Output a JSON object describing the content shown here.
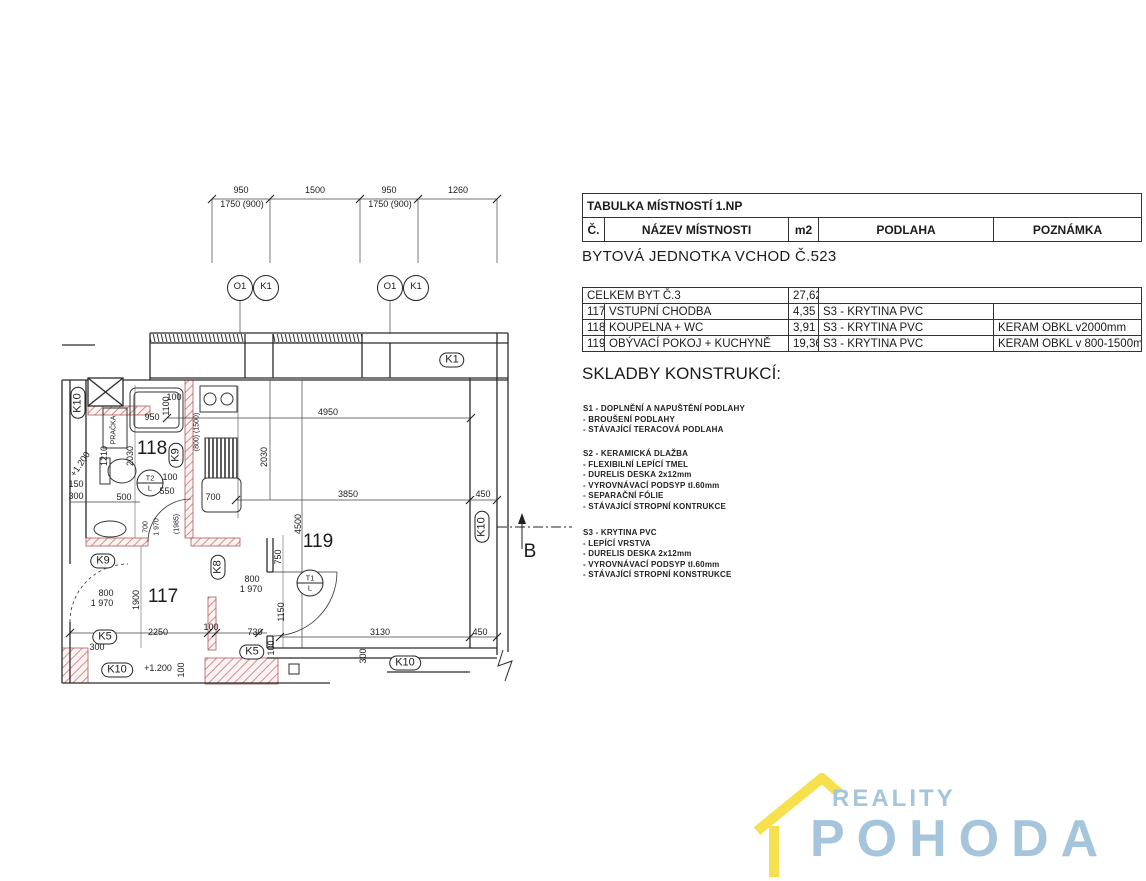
{
  "subtitle": "BYTOVÁ JEDNOTKA VCHOD Č.523",
  "room_table": {
    "title": "TABULKA MÍSTNOSTÍ 1.NP",
    "headers": [
      "Č.",
      "NÁZEV MÍSTNOSTI",
      "m2",
      "PODLAHA",
      "POZNÁMKA"
    ],
    "total_row": {
      "label": "CELKEM BYT Č.3",
      "m2": "27,62"
    },
    "rows": [
      {
        "no": "117",
        "name": "VSTUPNÍ CHODBA",
        "m2": "4,35",
        "floor": "S3 - KRYTINA PVC",
        "note": ""
      },
      {
        "no": "118",
        "name": "KOUPELNA + WC",
        "m2": "3,91",
        "floor": "S3 - KRYTINA PVC",
        "note": "KERAM OBKL v2000mm"
      },
      {
        "no": "119",
        "name": "OBÝVACÍ POKOJ + KUCHYNĚ",
        "m2": "19,36",
        "floor": "S3 - KRYTINA PVC",
        "note": "KERAM OBKL v 800-1500mm"
      }
    ]
  },
  "skladby": {
    "heading": "SKLADBY KONSTRUKCÍ:",
    "sections": [
      {
        "top": 404,
        "lines": [
          "S1 - DOPLNĚNÍ A NAPUŠTĚNÍ PODLAHY",
          " - BROUŠENÍ PODLAHY",
          " - STÁVAJÍCÍ TERACOVÁ PODLAHA"
        ]
      },
      {
        "top": 449,
        "lines": [
          "S2 - KERAMICKÁ DLAŽBA",
          " - FLEXIBILNÍ LEPÍCÍ TMEL",
          " - DURELIS DESKA 2x12mm",
          " - VYROVNÁVACÍ PODSYP tl.60mm",
          " - SEPARAČNÍ FÓLIE",
          " - STÁVAJÍCÍ STROPNÍ KONTRUKCE"
        ]
      },
      {
        "top": 528,
        "lines": [
          "S3 - KRYTINA PVC",
          " - LEPÍCÍ VRSTVA",
          " - DURELIS DESKA 2x12mm",
          " - VYROVNÁVACÍ PODSYP tl.60mm",
          " - STÁVAJÍCÍ STROPNÍ KONSTRUKCE"
        ]
      }
    ]
  },
  "logo": {
    "brand_top": "REALITY",
    "brand_bottom": "POHODA",
    "colors": {
      "roof": "#f6e04e",
      "text": "#a4c5db"
    }
  },
  "plan": {
    "colors": {
      "wall_hatch": "#d08f8f",
      "lines": "#2b2b2b"
    },
    "labels": [
      {
        "t": "950",
        "x": 241,
        "y": 190,
        "c": "d"
      },
      {
        "t": "1500",
        "x": 315,
        "y": 190,
        "c": "d"
      },
      {
        "t": "950",
        "x": 389,
        "y": 190,
        "c": "d"
      },
      {
        "t": "1260",
        "x": 458,
        "y": 190,
        "c": "d"
      },
      {
        "t": "1750 (900)",
        "x": 242,
        "y": 204,
        "c": "d"
      },
      {
        "t": "1750 (900)",
        "x": 390,
        "y": 204,
        "c": "d"
      },
      {
        "t": "O1",
        "x": 240,
        "y": 288,
        "c": "circ"
      },
      {
        "t": "K1",
        "x": 266,
        "y": 288,
        "c": "circ"
      },
      {
        "t": "O1",
        "x": 390,
        "y": 288,
        "c": "circ"
      },
      {
        "t": "K1",
        "x": 416,
        "y": 288,
        "c": "circ"
      },
      {
        "t": "K1",
        "x": 452,
        "y": 360,
        "c": "ov"
      },
      {
        "t": "K10",
        "x": 78,
        "y": 403,
        "c": "ovv"
      },
      {
        "t": "100",
        "x": 174,
        "y": 397,
        "c": "d"
      },
      {
        "t": "1100",
        "x": 166,
        "y": 406,
        "c": "dv"
      },
      {
        "t": "950",
        "x": 152,
        "y": 417,
        "c": "d"
      },
      {
        "t": "PRAČKA",
        "x": 114,
        "y": 430,
        "c": "dv7"
      },
      {
        "t": "2030",
        "x": 130,
        "y": 456,
        "c": "dv"
      },
      {
        "t": "+1.200",
        "x": 80,
        "y": 464,
        "c": "ds"
      },
      {
        "t": "1210",
        "x": 104,
        "y": 456,
        "c": "dv"
      },
      {
        "t": "150",
        "x": 76,
        "y": 484,
        "c": "d"
      },
      {
        "t": "300",
        "x": 76,
        "y": 496,
        "c": "d"
      },
      {
        "t": "500",
        "x": 124,
        "y": 497,
        "c": "d"
      },
      {
        "t": "118",
        "x": 152,
        "y": 449,
        "c": "room"
      },
      {
        "t": "K9",
        "x": 176,
        "y": 455,
        "c": "ovv"
      },
      {
        "t": "(800) (1500)",
        "x": 197,
        "y": 432,
        "c": "dv7"
      },
      {
        "t": "2030",
        "x": 264,
        "y": 457,
        "c": "dv"
      },
      {
        "t": "T2|L",
        "x": 150,
        "y": 483,
        "c": "c2"
      },
      {
        "t": "100",
        "x": 170,
        "y": 477,
        "c": "d"
      },
      {
        "t": "550",
        "x": 167,
        "y": 491,
        "c": "d"
      },
      {
        "t": "700",
        "x": 213,
        "y": 497,
        "c": "d"
      },
      {
        "t": "4950",
        "x": 328,
        "y": 412,
        "c": "d"
      },
      {
        "t": "3850",
        "x": 348,
        "y": 494,
        "c": "d"
      },
      {
        "t": "450",
        "x": 483,
        "y": 494,
        "c": "d"
      },
      {
        "t": "4500",
        "x": 298,
        "y": 524,
        "c": "dv"
      },
      {
        "t": "119",
        "x": 318,
        "y": 542,
        "c": "room"
      },
      {
        "t": "K10",
        "x": 482,
        "y": 527,
        "c": "ovv"
      },
      {
        "t": "B",
        "x": 530,
        "y": 552,
        "c": "bigB"
      },
      {
        "t": "T1|L",
        "x": 310,
        "y": 583,
        "c": "c2"
      },
      {
        "t": "750",
        "x": 278,
        "y": 557,
        "c": "dv"
      },
      {
        "t": "1150",
        "x": 281,
        "y": 612,
        "c": "dv"
      },
      {
        "t": "800",
        "x": 252,
        "y": 579,
        "c": "d"
      },
      {
        "t": "1 970",
        "x": 251,
        "y": 589,
        "c": "d"
      },
      {
        "t": "K8",
        "x": 218,
        "y": 567,
        "c": "ovv"
      },
      {
        "t": "700",
        "x": 146,
        "y": 527,
        "c": "dv7"
      },
      {
        "t": "1 970",
        "x": 157,
        "y": 527,
        "c": "dv7"
      },
      {
        "t": "(1985)",
        "x": 177,
        "y": 524,
        "c": "dv7"
      },
      {
        "t": "K9",
        "x": 103,
        "y": 561,
        "c": "ov"
      },
      {
        "t": "117",
        "x": 163,
        "y": 597,
        "c": "room"
      },
      {
        "t": "1900",
        "x": 136,
        "y": 600,
        "c": "dv"
      },
      {
        "t": "800",
        "x": 106,
        "y": 593,
        "c": "d"
      },
      {
        "t": "1 970",
        "x": 102,
        "y": 603,
        "c": "d"
      },
      {
        "t": "K5",
        "x": 105,
        "y": 637,
        "c": "ov"
      },
      {
        "t": "300",
        "x": 97,
        "y": 647,
        "c": "d"
      },
      {
        "t": "2250",
        "x": 158,
        "y": 632,
        "c": "d"
      },
      {
        "t": "100",
        "x": 211,
        "y": 627,
        "c": "d"
      },
      {
        "t": "730",
        "x": 255,
        "y": 632,
        "c": "d"
      },
      {
        "t": "K5",
        "x": 252,
        "y": 652,
        "c": "ov"
      },
      {
        "t": "100",
        "x": 271,
        "y": 648,
        "c": "dv"
      },
      {
        "t": "K10",
        "x": 117,
        "y": 670,
        "c": "ov"
      },
      {
        "t": "+1.200",
        "x": 158,
        "y": 668,
        "c": "d"
      },
      {
        "t": "100",
        "x": 181,
        "y": 670,
        "c": "dv"
      },
      {
        "t": "3130",
        "x": 380,
        "y": 632,
        "c": "d"
      },
      {
        "t": "450",
        "x": 480,
        "y": 632,
        "c": "d"
      },
      {
        "t": "300",
        "x": 363,
        "y": 656,
        "c": "dv"
      },
      {
        "t": "K10",
        "x": 405,
        "y": 663,
        "c": "ov"
      }
    ]
  }
}
